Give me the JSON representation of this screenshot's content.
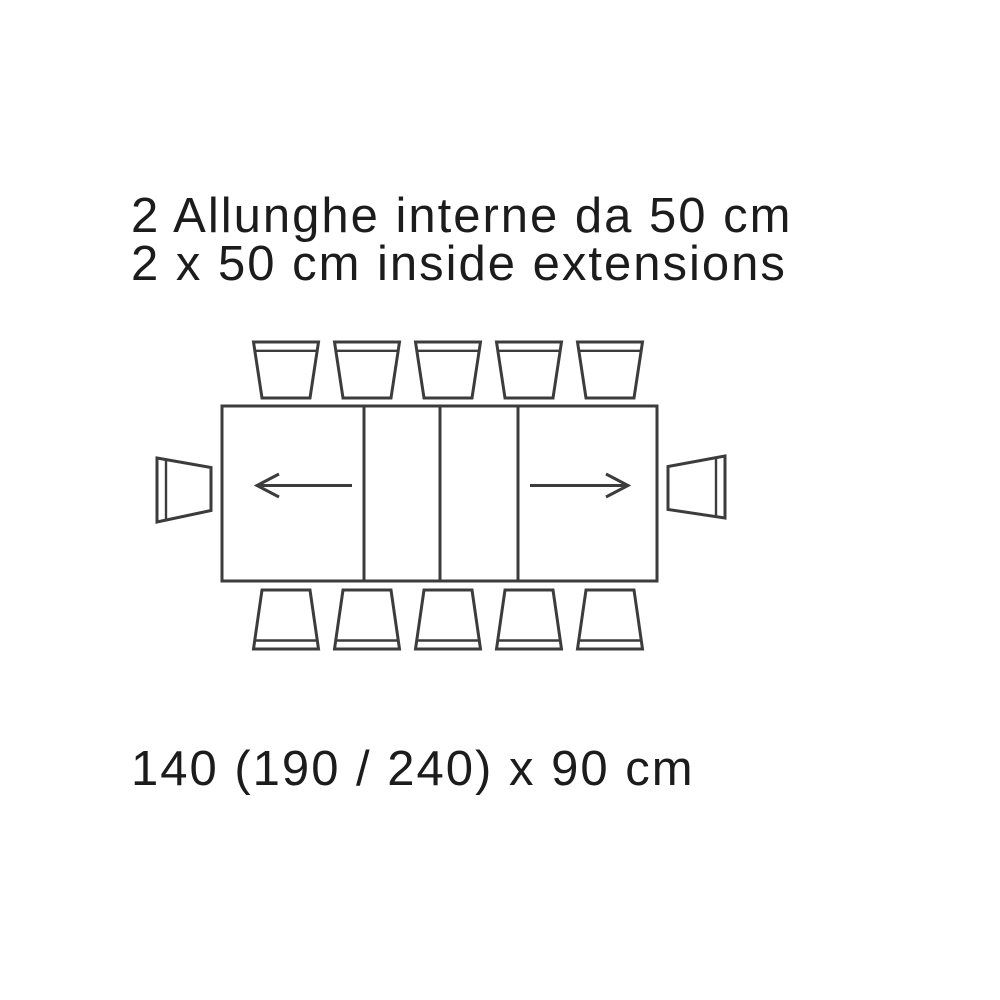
{
  "colors": {
    "canvas": "#ffffff",
    "line": "#3c3c3c",
    "text": "#1c1c1c"
  },
  "header": {
    "line1": "2 Allunghe interne da 50 cm",
    "line2": "2 x 50 cm inside extensions"
  },
  "footer": {
    "dimensions": "140 (190 / 240) x 90 cm"
  },
  "diagram": {
    "type": "extendable-table-plan-view",
    "table_sections": 4,
    "extension_leaves": 2,
    "extension_directions": [
      "left",
      "right"
    ],
    "chairs_top": 5,
    "chairs_bottom": 5,
    "chairs_left": 1,
    "chairs_right": 1,
    "chairs_total": 12
  }
}
